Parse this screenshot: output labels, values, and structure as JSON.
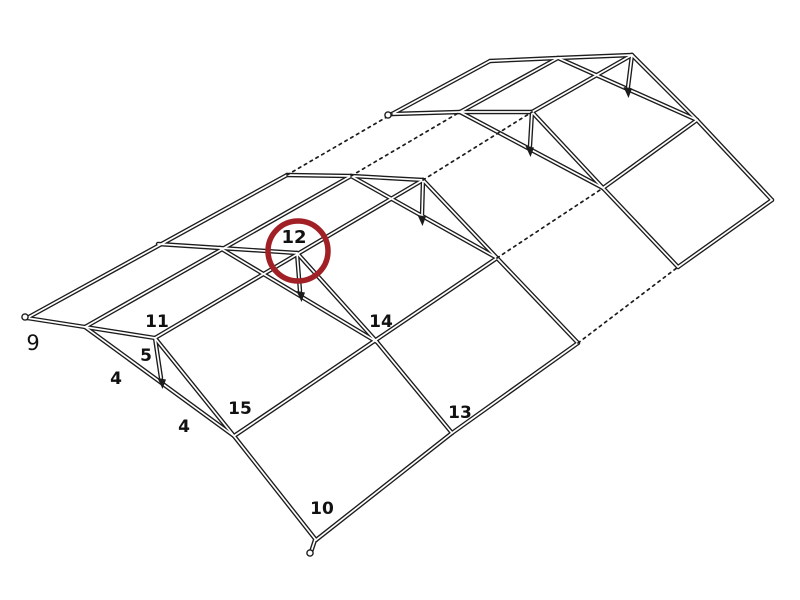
{
  "diagram": {
    "title": "tent-frame-assembly-diagram",
    "canvas": {
      "width": 800,
      "height": 600,
      "background": "#ffffff"
    },
    "colors": {
      "line": "#1c1c1c",
      "tube_core": "#ffffff",
      "highlight": "#a12025",
      "label": "#111111"
    },
    "part_labels": [
      {
        "id": "part-9",
        "text": "9",
        "x": 33,
        "y": 350,
        "size": 21,
        "weight": 400
      },
      {
        "id": "part-4a",
        "text": "4",
        "x": 116,
        "y": 384,
        "size": 17,
        "weight": 700
      },
      {
        "id": "part-5",
        "text": "5",
        "x": 146,
        "y": 361,
        "size": 17,
        "weight": 700
      },
      {
        "id": "part-11",
        "text": "11",
        "x": 157,
        "y": 327,
        "size": 17,
        "weight": 700
      },
      {
        "id": "part-4b",
        "text": "4",
        "x": 184,
        "y": 432,
        "size": 17,
        "weight": 700
      },
      {
        "id": "part-15",
        "text": "15",
        "x": 240,
        "y": 414,
        "size": 17,
        "weight": 700
      },
      {
        "id": "part-10",
        "text": "10",
        "x": 322,
        "y": 514,
        "size": 17,
        "weight": 700
      },
      {
        "id": "part-12",
        "text": "12",
        "x": 294,
        "y": 243,
        "size": 18,
        "weight": 700
      },
      {
        "id": "part-14",
        "text": "14",
        "x": 381,
        "y": 327,
        "size": 17,
        "weight": 700
      },
      {
        "id": "part-13",
        "text": "13",
        "x": 460,
        "y": 418,
        "size": 17,
        "weight": 700
      }
    ],
    "highlight_circle": {
      "cx": 298,
      "cy": 251,
      "r": 30,
      "stroke_width": 5.5,
      "highlights_part": "12"
    },
    "lines": {
      "solid": [
        [
          27,
          318,
          287,
          175
        ],
        [
          392,
          114,
          490,
          61
        ],
        [
          85,
          327,
          351,
          176
        ],
        [
          460,
          112,
          558,
          58
        ],
        [
          155,
          338,
          423,
          180
        ],
        [
          532,
          112,
          632,
          55
        ],
        [
          234,
          436,
          497,
          258
        ],
        [
          603,
          188,
          697,
          120
        ],
        [
          316,
          540,
          452,
          433
        ],
        [
          452,
          433,
          578,
          343
        ],
        [
          678,
          267,
          772,
          200
        ],
        [
          27,
          318,
          85,
          327
        ],
        [
          85,
          327,
          155,
          338
        ],
        [
          158,
          244,
          220,
          248
        ],
        [
          220,
          248,
          297,
          253
        ],
        [
          287,
          175,
          351,
          176
        ],
        [
          351,
          176,
          423,
          180
        ],
        [
          392,
          114,
          460,
          112
        ],
        [
          460,
          112,
          532,
          112
        ],
        [
          490,
          61,
          558,
          58
        ],
        [
          558,
          58,
          632,
          55
        ],
        [
          85,
          327,
          234,
          436
        ],
        [
          220,
          248,
          377,
          342
        ],
        [
          351,
          176,
          497,
          258
        ],
        [
          460,
          112,
          603,
          188
        ],
        [
          558,
          58,
          697,
          120
        ],
        [
          155,
          338,
          234,
          436
        ],
        [
          297,
          253,
          377,
          342
        ],
        [
          423,
          180,
          497,
          258
        ],
        [
          532,
          112,
          603,
          188
        ],
        [
          632,
          55,
          697,
          120
        ],
        [
          234,
          436,
          316,
          540
        ],
        [
          377,
          342,
          452,
          433
        ],
        [
          497,
          258,
          578,
          343
        ],
        [
          603,
          188,
          678,
          267
        ],
        [
          697,
          120,
          772,
          200
        ],
        [
          155,
          338,
          161,
          378
        ],
        [
          297,
          253,
          300,
          291
        ],
        [
          423,
          180,
          422,
          215
        ],
        [
          532,
          112,
          530,
          146
        ],
        [
          632,
          55,
          628,
          87
        ],
        [
          315,
          540,
          311,
          552
        ]
      ],
      "dotted": [
        [
          287,
          175,
          392,
          114
        ],
        [
          351,
          176,
          460,
          112
        ],
        [
          423,
          180,
          532,
          112
        ],
        [
          497,
          258,
          603,
          188
        ],
        [
          578,
          343,
          678,
          267
        ]
      ]
    },
    "stud_arrow_tips": [
      {
        "x": 162,
        "y": 384
      },
      {
        "x": 301,
        "y": 297
      },
      {
        "x": 422,
        "y": 221
      },
      {
        "x": 530,
        "y": 152
      },
      {
        "x": 628,
        "y": 93
      }
    ],
    "tube_end_caps": [
      {
        "x": 25,
        "y": 317
      },
      {
        "x": 388,
        "y": 115
      },
      {
        "x": 310,
        "y": 553
      }
    ]
  }
}
